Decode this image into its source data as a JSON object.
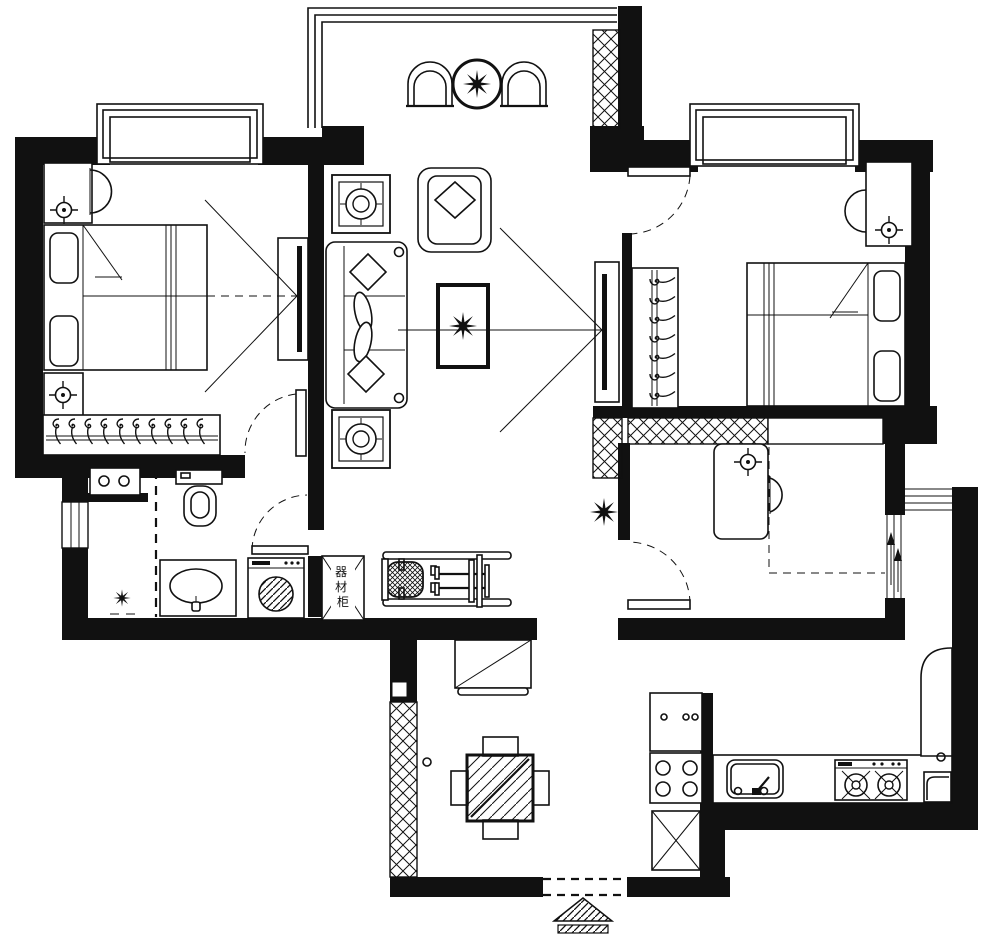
{
  "drawing": {
    "kind": "apartment-floor-plan",
    "colors": {
      "ink": "#111111",
      "paper": "#ffffff"
    },
    "equipment_cabinet": {
      "label": "器材柜",
      "chars": [
        "器",
        "材",
        "柜"
      ]
    },
    "icons": {
      "plant": "spiky-star",
      "ceiling-lamp": "crosshair-circle",
      "clothes-hanger": "hook-curl",
      "gas-burner": "circle-with-x",
      "side-table": "nested-squares-circle",
      "door-swing": "dashed-quarter-arc",
      "shaft-hatch": "x-lattice",
      "entry-marker": "hatched-triangle",
      "sliding-door": "triple-line-arrows",
      "bay-window": "nested-frames"
    },
    "furniture": [
      "double-bed",
      "nightstand",
      "wardrobe-hangers",
      "tv-panel",
      "sofa",
      "armchair",
      "coffee-table-plant",
      "balcony-chair",
      "round-table-plant",
      "toilet",
      "washbasin",
      "washing-machine",
      "equipment-cabinet",
      "weight-bench",
      "desk",
      "desk-chair",
      "dining-table",
      "dining-chair",
      "shoe-cabinet",
      "kitchen-sink",
      "gas-stove",
      "refrigerator",
      "entry-arrow"
    ]
  }
}
